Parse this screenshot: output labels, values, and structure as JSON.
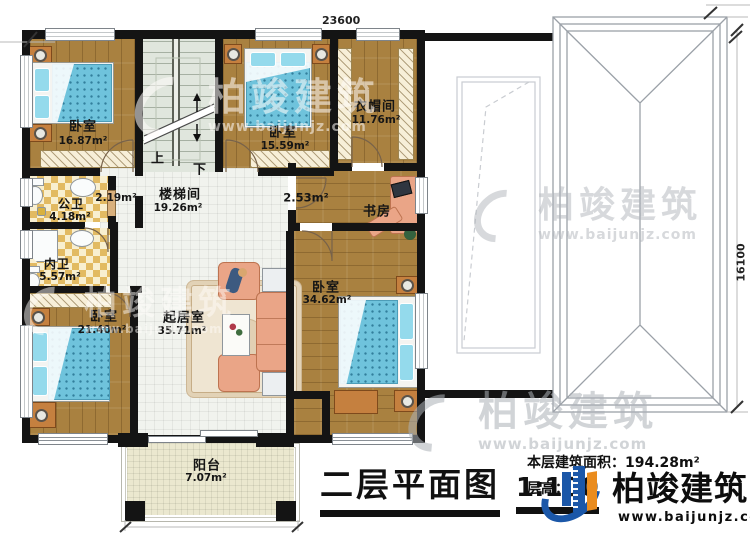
{
  "dimensions": {
    "top": "23600",
    "right": "16100"
  },
  "rooms": {
    "bedroom1": {
      "name": "卧室",
      "area": "16.87m²"
    },
    "bedroom2": {
      "name": "卧室",
      "area": "15.59m²"
    },
    "cloakroom": {
      "name": "衣帽间",
      "area": "11.76m²"
    },
    "stairwell": {
      "name": "楼梯间",
      "area": "19.26m²"
    },
    "corridor": {
      "area": "2.19m²"
    },
    "hallway": {
      "area": "2.53m²"
    },
    "study": {
      "name": "书房"
    },
    "public_bath": {
      "name": "公卫",
      "area": "4.18m²"
    },
    "private_bath": {
      "name": "内卫",
      "area": "5.57m²"
    },
    "bedroom3": {
      "name": "卧室",
      "area": "21.40m²"
    },
    "living_room": {
      "name": "起居室",
      "area": "35.71m²"
    },
    "bedroom4": {
      "name": "卧室",
      "area": "34.62m²"
    },
    "balcony": {
      "name": "阳台",
      "area": "7.07m²"
    }
  },
  "stairs": {
    "up": "上",
    "down": "下"
  },
  "title": {
    "text": "二层平面图",
    "scale": "1:100"
  },
  "info": {
    "area_label": "本层建筑面积：",
    "area_value": "194.28m²",
    "height_label": "层高：",
    "height_value": "3"
  },
  "logo": {
    "name": "柏竣建筑",
    "url": "www.baijunjz.com"
  },
  "watermark": {
    "name": "柏竣建筑",
    "url": "www.baijunjz.com"
  },
  "colors": {
    "wall": "#141414",
    "wood": "#a98140",
    "bed": "#6fc3dc",
    "sofa": "#eaa587",
    "logo_blue": "#1b57a8",
    "logo_orange": "#ea8c1e"
  }
}
